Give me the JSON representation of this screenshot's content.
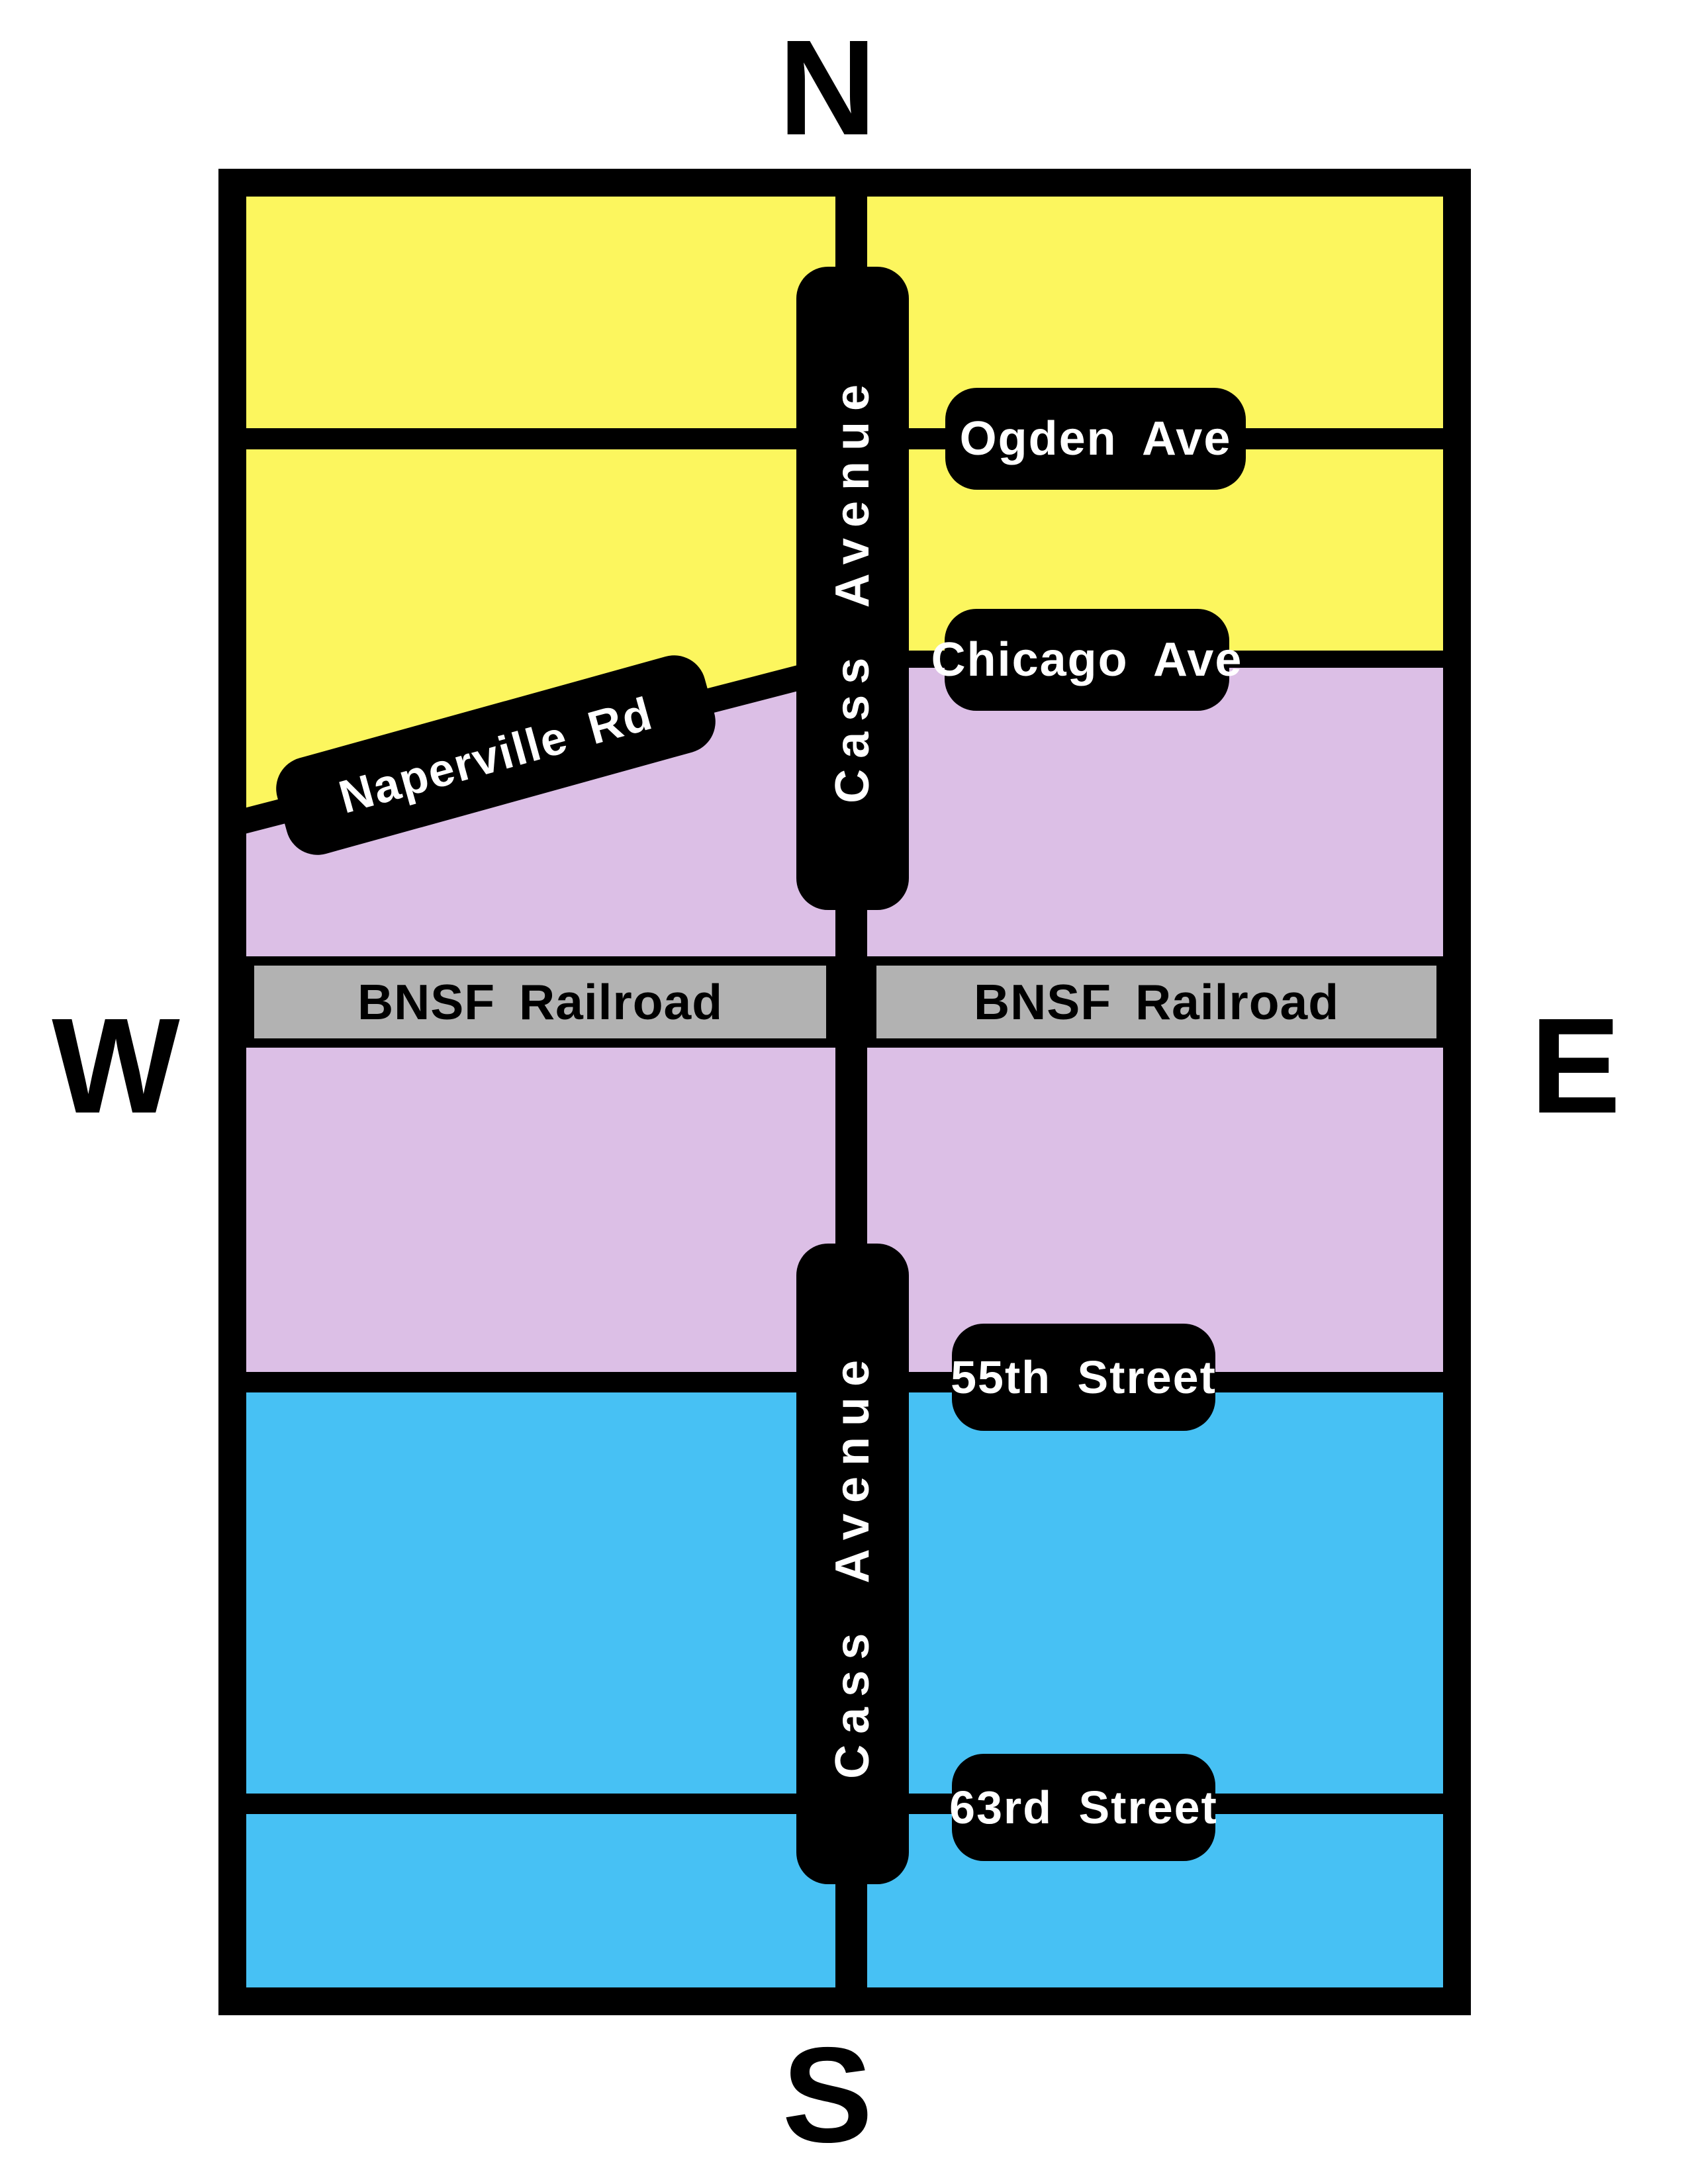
{
  "compass": {
    "north": "N",
    "west": "W",
    "east": "E",
    "south": "S"
  },
  "streets": {
    "cass_avenue": {
      "label": "Cass Avenue"
    },
    "ogden": {
      "label": "Ogden Ave"
    },
    "chicago": {
      "label": "Chicago Ave"
    },
    "naperville": {
      "label": "Naperville Rd"
    },
    "street_55": {
      "label": "55th Street"
    },
    "street_63": {
      "label": "63rd Street"
    },
    "railroad": {
      "label": "BNSF Railroad"
    }
  },
  "colors": {
    "north_zone_yellow": "#FCF65E",
    "central_zone_purple": "#DCBFE6",
    "south_zone_blue": "#47C1F4",
    "railroad_gray": "#B2B2B2",
    "road_black": "#000000",
    "sign_text_white": "#FFFFFF"
  }
}
